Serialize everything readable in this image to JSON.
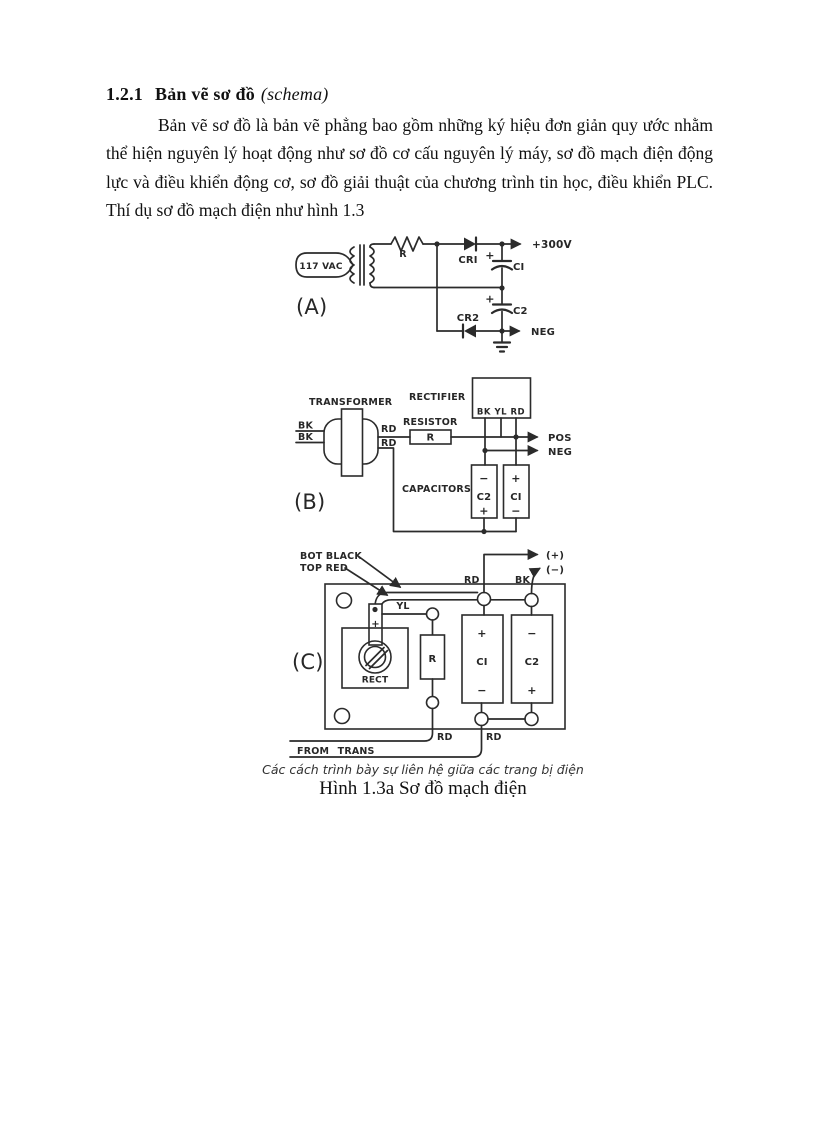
{
  "document": {
    "heading": {
      "number": "1.2.1",
      "title": "Bản vẽ sơ đồ",
      "subtitle": "(schema)"
    },
    "paragraph": "Bản vẽ sơ đồ là bản vẽ phẳng bao gồm những ký hiệu đơn giản quy ước nhằm thể hiện nguyên lý hoạt động như sơ đồ cơ cấu nguyên lý máy, sơ đồ mạch điện động lực và điều khiển động cơ, sơ đồ giải thuật của chương trình tin học, điều khiển PLC. Thí dụ sơ đồ mạch điện như hình 1.3"
  },
  "figure": {
    "a": {
      "label": "(A)",
      "source": "117 VAC",
      "r": "R",
      "cr1": "CRI",
      "c1": "CI",
      "c2": "C2",
      "cr2": "CR2",
      "pos": "+300V",
      "neg": "NEG",
      "plus": "+"
    },
    "b": {
      "label": "(B)",
      "transformer": "TRANSFORMER",
      "rectifier": "RECTIFIER",
      "resistor": "RESISTOR",
      "capacitors": "CAPACITORS",
      "bk": "BK",
      "rd": "RD",
      "r": "R",
      "terminals": "BK YL RD",
      "pos": "POS",
      "neg": "NEG",
      "c1": "CI",
      "c2": "C2",
      "plus": "+",
      "minus": "−"
    },
    "c": {
      "label": "(C)",
      "bot_black": "BOT BLACK",
      "top_red": "TOP RED",
      "out_pos": "(+)",
      "out_neg": "(−)",
      "rd": "RD",
      "bk": "BK",
      "yl": "YL",
      "plus": "+",
      "minus": "−",
      "r": "R",
      "c1": "CI",
      "c2": "C2",
      "rect": "RECT",
      "from_trans": "FROM TRANS"
    },
    "caption_note": "Các cách trình bày sự liên hệ giữa các trang bị điện",
    "caption_title": "Hình 1.3a Sơ đồ mạch điện"
  },
  "colors": {
    "ink": "#2b2b2b",
    "paper": "#ffffff"
  }
}
